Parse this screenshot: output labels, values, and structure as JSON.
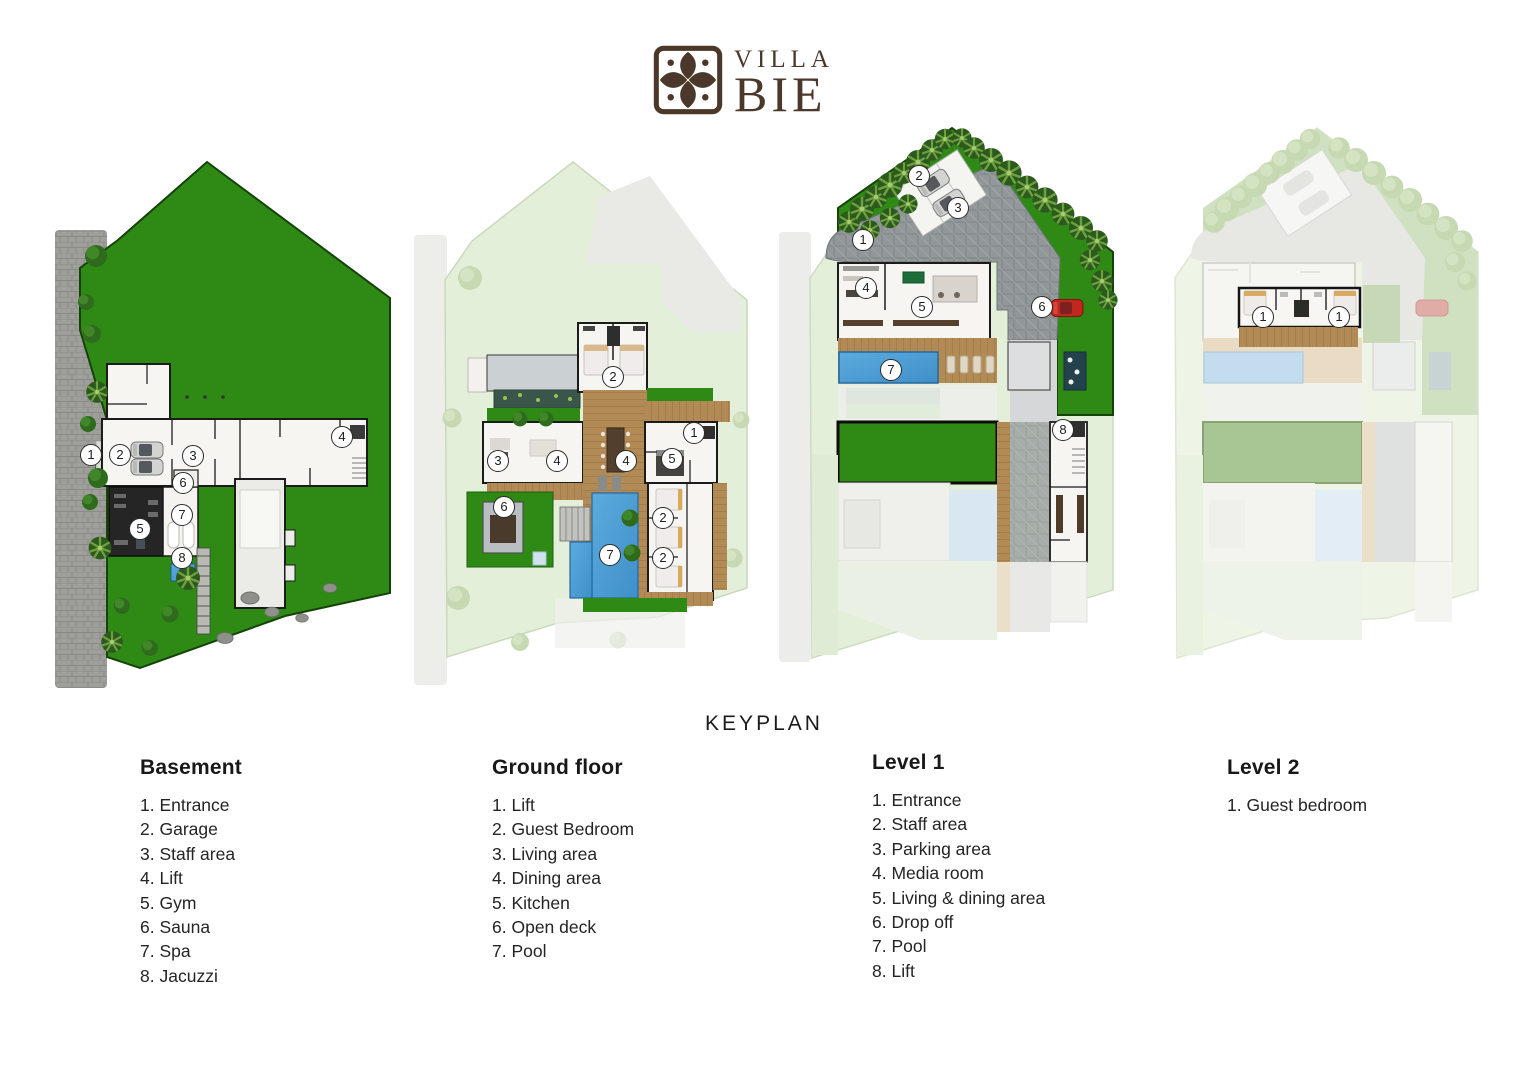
{
  "logo": {
    "line1": "VILLA",
    "line2": "BIE"
  },
  "keyplan_label": "KEYPLAN",
  "colors": {
    "brand_brown": "#4b382b",
    "grass_green": "#2e8a15",
    "pool_blue": "#4f9ed6",
    "wood": "#b28a55",
    "stone_gray": "#93989a",
    "faded_green": "#e4efda",
    "text": "#1f1f1f"
  },
  "plans": [
    {
      "id": "basement",
      "title": "Basement",
      "items": [
        {
          "num": "1.",
          "label": "Entrance"
        },
        {
          "num": "2.",
          "label": "Garage"
        },
        {
          "num": "3.",
          "label": "Staff area"
        },
        {
          "num": "4.",
          "label": "Lift"
        },
        {
          "num": "5.",
          "label": "Gym"
        },
        {
          "num": "6.",
          "label": "Sauna"
        },
        {
          "num": "7.",
          "label": "Spa"
        },
        {
          "num": "8.",
          "label": "Jacuzzi"
        }
      ],
      "markers": [
        {
          "n": "1",
          "x": 91,
          "y": 455
        },
        {
          "n": "2",
          "x": 120,
          "y": 455
        },
        {
          "n": "3",
          "x": 193,
          "y": 456
        },
        {
          "n": "4",
          "x": 342,
          "y": 437
        },
        {
          "n": "5",
          "x": 140,
          "y": 529
        },
        {
          "n": "6",
          "x": 183,
          "y": 483
        },
        {
          "n": "7",
          "x": 182,
          "y": 515
        },
        {
          "n": "8",
          "x": 182,
          "y": 558
        }
      ]
    },
    {
      "id": "ground-floor",
      "title": "Ground floor",
      "items": [
        {
          "num": "1.",
          "label": "Lift"
        },
        {
          "num": "2.",
          "label": "Guest Bedroom"
        },
        {
          "num": "3.",
          "label": "Living area"
        },
        {
          "num": "4.",
          "label": "Dining area"
        },
        {
          "num": "5.",
          "label": "Kitchen"
        },
        {
          "num": "6.",
          "label": "Open deck"
        },
        {
          "num": "7.",
          "label": "Pool"
        }
      ],
      "markers": [
        {
          "n": "2",
          "x": 613,
          "y": 377
        },
        {
          "n": "1",
          "x": 694,
          "y": 433
        },
        {
          "n": "3",
          "x": 498,
          "y": 461
        },
        {
          "n": "4",
          "x": 557,
          "y": 461
        },
        {
          "n": "4",
          "x": 626,
          "y": 461
        },
        {
          "n": "5",
          "x": 672,
          "y": 459
        },
        {
          "n": "6",
          "x": 504,
          "y": 507
        },
        {
          "n": "2",
          "x": 663,
          "y": 518
        },
        {
          "n": "7",
          "x": 610,
          "y": 555
        },
        {
          "n": "2",
          "x": 663,
          "y": 558
        }
      ]
    },
    {
      "id": "level-1",
      "title": "Level 1",
      "items": [
        {
          "num": "1.",
          "label": "Entrance"
        },
        {
          "num": "2.",
          "label": "Staff area"
        },
        {
          "num": "3.",
          "label": "Parking area"
        },
        {
          "num": "4.",
          "label": "Media room"
        },
        {
          "num": "5.",
          "label": "Living & dining area"
        },
        {
          "num": "6.",
          "label": "Drop off"
        },
        {
          "num": "7.",
          "label": "Pool"
        },
        {
          "num": "8.",
          "label": "Lift"
        }
      ],
      "markers": [
        {
          "n": "1",
          "x": 863,
          "y": 240
        },
        {
          "n": "2",
          "x": 919,
          "y": 176
        },
        {
          "n": "3",
          "x": 958,
          "y": 208
        },
        {
          "n": "4",
          "x": 866,
          "y": 288
        },
        {
          "n": "5",
          "x": 922,
          "y": 307
        },
        {
          "n": "6",
          "x": 1042,
          "y": 307
        },
        {
          "n": "7",
          "x": 891,
          "y": 370
        },
        {
          "n": "8",
          "x": 1063,
          "y": 430
        }
      ]
    },
    {
      "id": "level-2",
      "title": "Level 2",
      "items": [
        {
          "num": "1.",
          "label": "Guest bedroom"
        }
      ],
      "markers": [
        {
          "n": "1",
          "x": 1263,
          "y": 317
        },
        {
          "n": "1",
          "x": 1339,
          "y": 317
        }
      ]
    }
  ]
}
